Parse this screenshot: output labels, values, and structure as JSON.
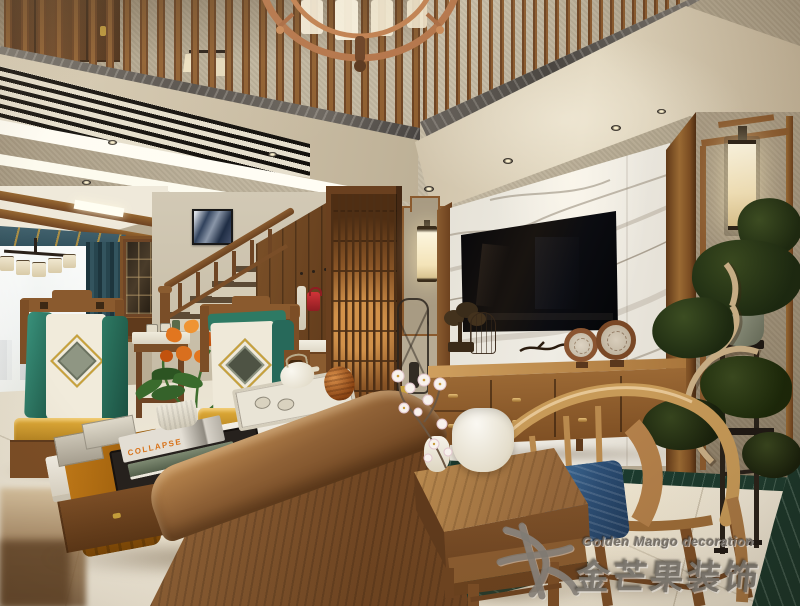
{
  "watermark": {
    "line1": "Golden Mango decoration",
    "line2": "金芒果装饰"
  },
  "coffee_table": {
    "book_spine": "COLLAPSE"
  },
  "palette": {
    "wall_texture": "#b3a78f",
    "fascia_beige": "#d8cdb6",
    "wood_dark": "#5f3a1c",
    "wood": "#7c4e26",
    "wood_light": "#b98a4e",
    "copper_chandelier": "#b5764a",
    "marble_tv_wall": "#e9e5dc",
    "marble_vein": "#a39a8a",
    "tv_black": "#0a0a0c",
    "floor_cream": "#efe8d6",
    "green_marble_inlay": "#1a3a2e",
    "curtain_teal": "#2c4852",
    "valance_gold": "#c59a3c",
    "cushion_teal": "#2e7a64",
    "cushion_ivory": "#f0ead9",
    "seat_cushion_gold": "#cf9c33",
    "flower_orange": "#d96f1e",
    "hoop_chair_cushion_blue": "#2b4d74",
    "bonsai_pine_green": "#222f16",
    "sconce_glow": "#f7ecd2",
    "red_bag": "#bb2a2e"
  },
  "scene_objects": [
    "copper ring chandelier",
    "wood balustrade with marble edge",
    "linear AC vent",
    "LED cove lighting",
    "dining chandelier with drum shades",
    "teal curtains with gold valance",
    "staircase with wood railing",
    "abstract wall art",
    "wood lattice screen",
    "framed fabric wall panels with glowing sconces",
    "marble TV feature wall",
    "wall-mounted flat-screen TV",
    "wood TV sideboard with ring ornaments",
    "cascading bonsai pine on black stand",
    "Chinese armchairs with medallion cushions",
    "orange flower arrangement",
    "marble-top coffee table with tea tray and books",
    "square wood tea table with white jar and blossoms",
    "hoop-back chair with blue cushion",
    "cream marble floor with green marble inlay",
    "studio watermark"
  ]
}
